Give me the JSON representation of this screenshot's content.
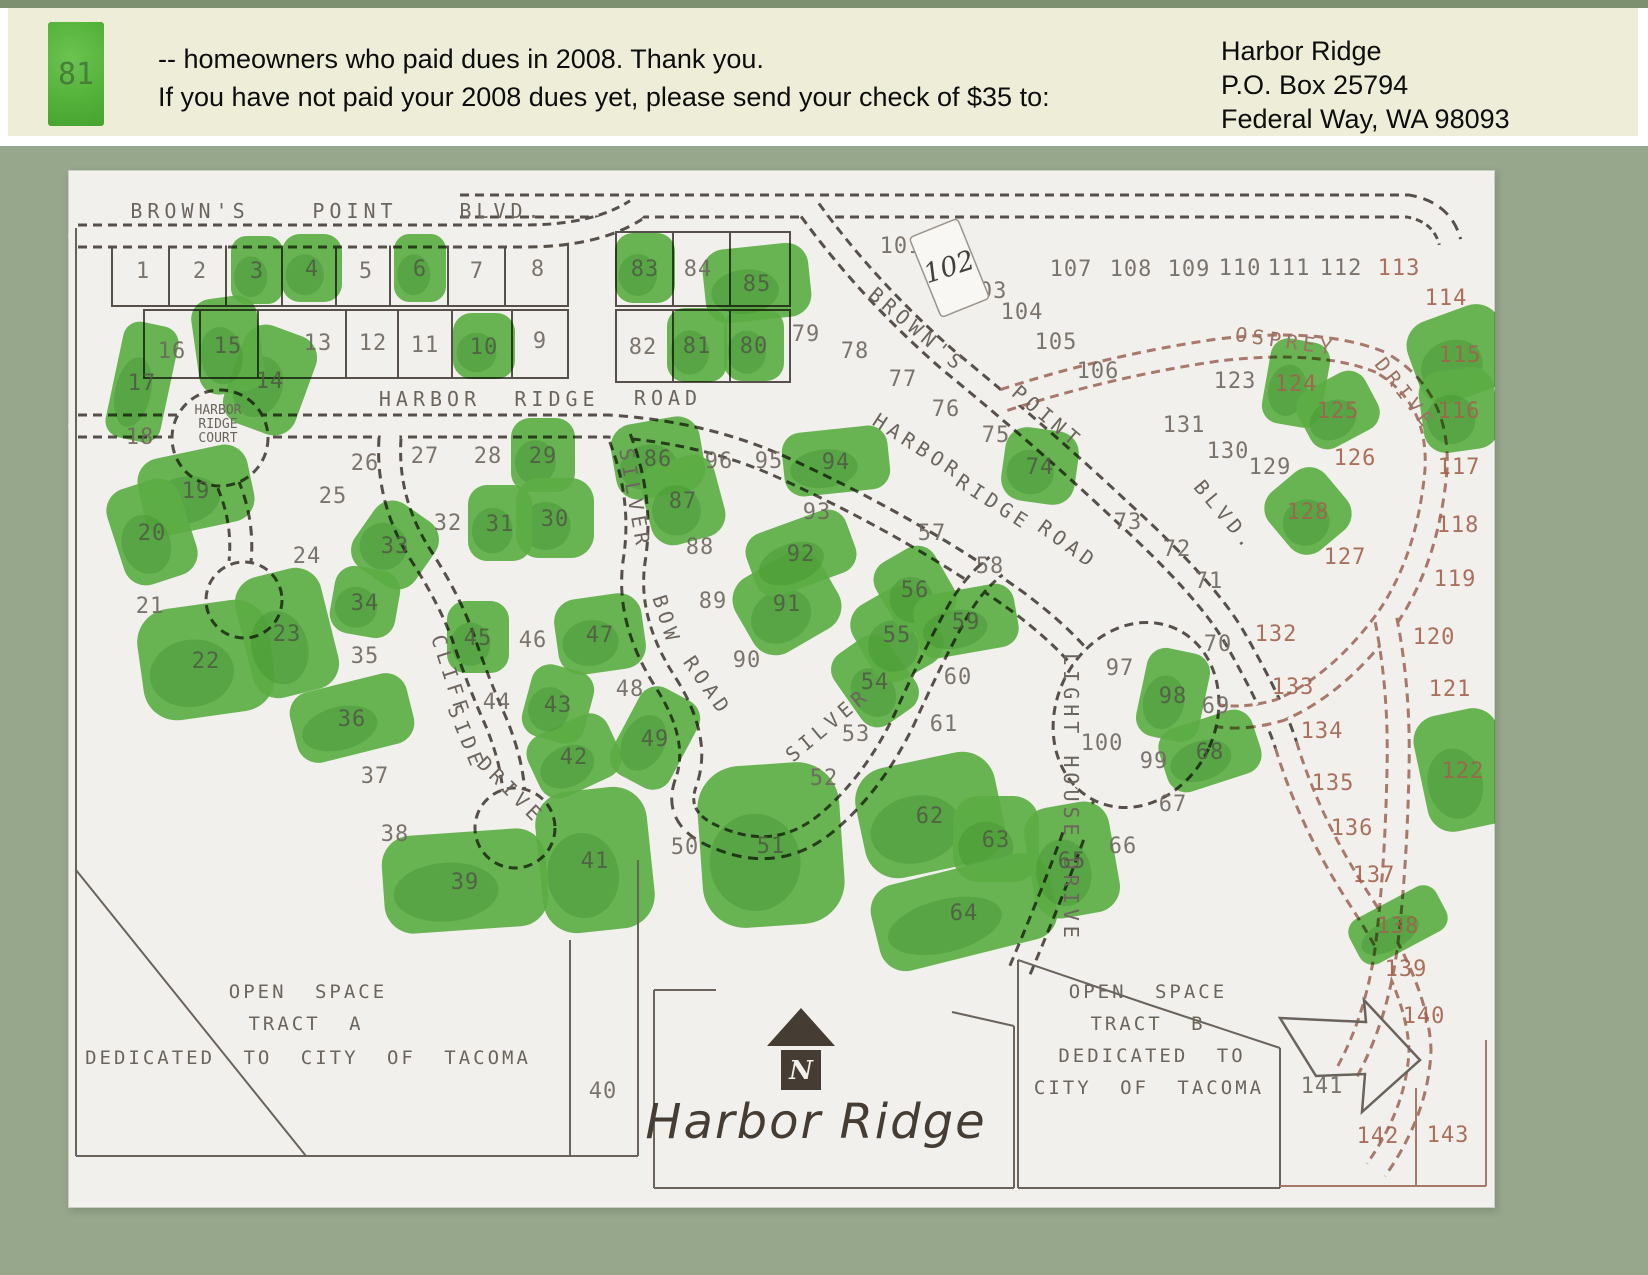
{
  "header": {
    "legend_number": "81",
    "line1": "-- homeowners who paid dues in 2008. Thank you.",
    "line2": "If you have not paid your 2008 dues yet, please send your check of $35 to:",
    "address_lines": [
      "Harbor Ridge",
      "P.O. Box 25794",
      "Federal Way, WA 98093"
    ]
  },
  "colors": {
    "page_bg": "#96a78c",
    "top_strip": "#7d9171",
    "header_bg": "#eeeed8",
    "paper": "#f2f0ec",
    "paid_green": "#62b94a",
    "paid_green_dark": "#3f9630",
    "line_dark": "#57504a",
    "line_red": "#a8796a",
    "number_black": "#6e6760",
    "number_on_green": "#505c44",
    "number_red": "#a2624d",
    "street_text": "#6b655e",
    "street_text_red": "#9b7365",
    "ink": "#453d33"
  },
  "map": {
    "script_title": "Harbor Ridge",
    "north_letter": "N",
    "court_label": [
      "HARBOR",
      "RIDGE",
      "COURT"
    ],
    "handwritten_lot": {
      "n": "102",
      "x": 881,
      "y": 97
    },
    "open_space_labels": [
      {
        "text": "OPEN SPACE",
        "x": 240,
        "y": 828
      },
      {
        "text": "TRACT A",
        "x": 238,
        "y": 860
      },
      {
        "text": "DEDICATED TO CITY OF TACOMA",
        "x": 240,
        "y": 894
      },
      {
        "text": "OPEN SPACE",
        "x": 1080,
        "y": 828
      },
      {
        "text": "TRACT B",
        "x": 1080,
        "y": 860
      },
      {
        "text": "DEDICATED TO",
        "x": 1084,
        "y": 892
      },
      {
        "text": "CITY OF TACOMA",
        "x": 1081,
        "y": 924
      }
    ],
    "street_labels": [
      {
        "text": "BROWN'S",
        "x": 122,
        "y": 48,
        "rot": 0,
        "red": false
      },
      {
        "text": "POINT",
        "x": 287,
        "y": 48,
        "rot": 0,
        "red": false
      },
      {
        "text": "BLVD.",
        "x": 434,
        "y": 48,
        "rot": 0,
        "red": false
      },
      {
        "text": "BROWN'S",
        "x": 845,
        "y": 165,
        "rot": 40,
        "red": false
      },
      {
        "text": "POINT",
        "x": 975,
        "y": 252,
        "rot": 40,
        "red": false
      },
      {
        "text": "BLVD.",
        "x": 1152,
        "y": 350,
        "rot": 50,
        "red": false
      },
      {
        "text": "HARBOR",
        "x": 362,
        "y": 236,
        "rot": 0,
        "red": false
      },
      {
        "text": "RIDGE",
        "x": 489,
        "y": 236,
        "rot": 0,
        "red": false
      },
      {
        "text": "ROAD",
        "x": 600,
        "y": 235,
        "rot": 0,
        "red": false
      },
      {
        "text": "HARBOR",
        "x": 846,
        "y": 282,
        "rot": 33,
        "red": false
      },
      {
        "text": "RIDGE",
        "x": 922,
        "y": 338,
        "rot": 33,
        "red": false
      },
      {
        "text": "ROAD",
        "x": 996,
        "y": 380,
        "rot": 36,
        "red": false
      },
      {
        "text": "SILVER",
        "x": 560,
        "y": 330,
        "rot": 80,
        "red": false
      },
      {
        "text": "BOW",
        "x": 592,
        "y": 452,
        "rot": 72,
        "red": false
      },
      {
        "text": "ROAD",
        "x": 634,
        "y": 520,
        "rot": 55,
        "red": false
      },
      {
        "text": "SILVER",
        "x": 764,
        "y": 560,
        "rot": -40,
        "red": false
      },
      {
        "text": "CLIFF",
        "x": 376,
        "y": 508,
        "rot": 72,
        "red": false
      },
      {
        "text": "SIDE",
        "x": 392,
        "y": 570,
        "rot": 68,
        "red": false
      },
      {
        "text": "DRIVE",
        "x": 438,
        "y": 625,
        "rot": 45,
        "red": false
      },
      {
        "text": "LIGHT HOUSE DRIVE",
        "x": 996,
        "y": 628,
        "rot": 90,
        "red": false
      },
      {
        "text": "OSPREY",
        "x": 1217,
        "y": 178,
        "rot": 8,
        "red": true
      },
      {
        "text": "DRIVE",
        "x": 1332,
        "y": 228,
        "rot": 52,
        "red": true
      }
    ],
    "lots": [
      [
        1,
        75,
        100,
        0,
        0
      ],
      [
        2,
        132,
        100,
        0,
        0
      ],
      [
        3,
        189,
        100,
        1,
        0,
        52,
        68,
        0
      ],
      [
        4,
        244,
        98,
        1,
        0,
        60,
        68,
        0
      ],
      [
        5,
        298,
        100,
        0,
        0
      ],
      [
        6,
        352,
        98,
        1,
        0,
        52,
        68,
        0
      ],
      [
        7,
        409,
        100,
        0,
        0
      ],
      [
        8,
        470,
        98,
        0,
        0
      ],
      [
        9,
        472,
        170,
        0,
        0
      ],
      [
        10,
        416,
        176,
        1,
        0,
        62,
        66,
        0
      ],
      [
        11,
        357,
        174,
        0,
        0
      ],
      [
        12,
        305,
        172,
        0,
        0
      ],
      [
        13,
        250,
        172,
        0,
        0
      ],
      [
        14,
        202,
        210,
        1,
        0,
        76,
        104,
        20
      ],
      [
        15,
        160,
        175,
        1,
        0,
        66,
        96,
        -8
      ],
      [
        16,
        104,
        180,
        0,
        0
      ],
      [
        17,
        74,
        212,
        1,
        0,
        56,
        118,
        12
      ],
      [
        18,
        72,
        266,
        0,
        0
      ],
      [
        19,
        128,
        320,
        1,
        0,
        112,
        78,
        -12
      ],
      [
        20,
        84,
        362,
        1,
        0,
        76,
        100,
        -18
      ],
      [
        21,
        82,
        435,
        0,
        0
      ],
      [
        22,
        138,
        490,
        1,
        0,
        132,
        112,
        -8
      ],
      [
        23,
        219,
        463,
        1,
        0,
        88,
        124,
        -14
      ],
      [
        24,
        239,
        385,
        0,
        0
      ],
      [
        25,
        265,
        325,
        0,
        0
      ],
      [
        26,
        297,
        292,
        0,
        0
      ],
      [
        27,
        357,
        285,
        0,
        0
      ],
      [
        28,
        420,
        285,
        0,
        0
      ],
      [
        29,
        475,
        285,
        1,
        0,
        64,
        74,
        0
      ],
      [
        30,
        487,
        348,
        1,
        0,
        78,
        80,
        0
      ],
      [
        31,
        432,
        353,
        1,
        0,
        64,
        76,
        0
      ],
      [
        32,
        380,
        352,
        0,
        0
      ],
      [
        33,
        327,
        375,
        1,
        0,
        74,
        78,
        35
      ],
      [
        34,
        297,
        432,
        1,
        0,
        66,
        68,
        10
      ],
      [
        35,
        297,
        485,
        0,
        0
      ],
      [
        36,
        284,
        548,
        1,
        0,
        120,
        72,
        -14
      ],
      [
        37,
        307,
        605,
        0,
        0
      ],
      [
        38,
        327,
        663,
        0,
        0
      ],
      [
        39,
        397,
        711,
        1,
        0,
        164,
        98,
        -4
      ],
      [
        40,
        535,
        920,
        0,
        0
      ],
      [
        41,
        527,
        690,
        1,
        0,
        112,
        142,
        -6
      ],
      [
        42,
        506,
        586,
        1,
        0,
        88,
        68,
        -25
      ],
      [
        43,
        490,
        534,
        1,
        0,
        64,
        74,
        15
      ],
      [
        44,
        429,
        531,
        0,
        0
      ],
      [
        45,
        410,
        467,
        1,
        0,
        62,
        72,
        0
      ],
      [
        46,
        465,
        469,
        0,
        0
      ],
      [
        47,
        532,
        464,
        1,
        0,
        88,
        76,
        -8
      ],
      [
        48,
        562,
        518,
        0,
        0
      ],
      [
        49,
        587,
        568,
        1,
        0,
        66,
        98,
        28
      ],
      [
        50,
        617,
        676,
        0,
        0
      ],
      [
        51,
        703,
        675,
        1,
        0,
        142,
        162,
        -4
      ],
      [
        52,
        756,
        607,
        0,
        0
      ],
      [
        53,
        788,
        563,
        0,
        0
      ],
      [
        54,
        807,
        511,
        1,
        0,
        66,
        86,
        -35
      ],
      [
        55,
        829,
        464,
        1,
        0,
        78,
        86,
        -30
      ],
      [
        56,
        847,
        419,
        1,
        0,
        68,
        78,
        -30
      ],
      [
        57,
        864,
        362,
        0,
        0
      ],
      [
        58,
        922,
        395,
        0,
        0
      ],
      [
        59,
        898,
        451,
        1,
        0,
        102,
        64,
        -10
      ],
      [
        60,
        890,
        506,
        0,
        0
      ],
      [
        61,
        876,
        553,
        0,
        0
      ],
      [
        62,
        862,
        645,
        1,
        0,
        142,
        112,
        -12
      ],
      [
        63,
        928,
        669,
        1,
        0,
        86,
        86,
        0
      ],
      [
        64,
        896,
        742,
        1,
        0,
        182,
        88,
        -14
      ],
      [
        65,
        1004,
        690,
        1,
        0,
        86,
        112,
        -10
      ],
      [
        66,
        1055,
        675,
        0,
        0
      ],
      [
        67,
        1105,
        633,
        0,
        0
      ],
      [
        68,
        1142,
        581,
        1,
        0,
        98,
        66,
        -18
      ],
      [
        69,
        1148,
        535,
        0,
        0
      ],
      [
        70,
        1150,
        473,
        0,
        0
      ],
      [
        71,
        1141,
        410,
        0,
        0
      ],
      [
        72,
        1109,
        378,
        0,
        0
      ],
      [
        73,
        1060,
        351,
        0,
        0
      ],
      [
        74,
        972,
        296,
        1,
        0,
        74,
        74,
        8
      ],
      [
        75,
        928,
        264,
        0,
        0
      ],
      [
        76,
        878,
        238,
        0,
        0
      ],
      [
        77,
        835,
        208,
        0,
        0
      ],
      [
        78,
        787,
        180,
        0,
        0
      ],
      [
        79,
        738,
        163,
        0,
        0
      ],
      [
        80,
        686,
        175,
        1,
        0,
        60,
        72,
        0
      ],
      [
        81,
        629,
        175,
        1,
        0,
        60,
        74,
        0
      ],
      [
        82,
        575,
        176,
        0,
        0
      ],
      [
        83,
        577,
        98,
        1,
        0,
        60,
        70,
        0
      ],
      [
        84,
        630,
        98,
        0,
        0
      ],
      [
        85,
        689,
        113,
        1,
        0,
        106,
        74,
        -6
      ],
      [
        86,
        590,
        288,
        1,
        0,
        90,
        76,
        -10
      ],
      [
        87,
        615,
        330,
        1,
        0,
        76,
        84,
        -15
      ],
      [
        88,
        632,
        376,
        0,
        0
      ],
      [
        89,
        645,
        430,
        0,
        0
      ],
      [
        90,
        679,
        489,
        0,
        0
      ],
      [
        91,
        719,
        433,
        1,
        0,
        98,
        86,
        -30
      ],
      [
        92,
        733,
        383,
        1,
        0,
        106,
        66,
        -20
      ],
      [
        93,
        749,
        341,
        0,
        0
      ],
      [
        94,
        768,
        291,
        1,
        0,
        106,
        64,
        -6
      ],
      [
        95,
        701,
        290,
        0,
        0
      ],
      [
        96,
        651,
        290,
        0,
        0
      ],
      [
        97,
        1052,
        497,
        0,
        0
      ],
      [
        98,
        1105,
        525,
        1,
        0,
        64,
        90,
        12
      ],
      [
        99,
        1086,
        590,
        0,
        0
      ],
      [
        100,
        1034,
        572,
        0,
        0
      ],
      [
        101,
        833,
        75,
        0,
        0
      ],
      [
        103,
        918,
        120,
        0,
        0
      ],
      [
        104,
        954,
        141,
        0,
        0
      ],
      [
        105,
        988,
        171,
        0,
        0
      ],
      [
        106,
        1030,
        200,
        0,
        0
      ],
      [
        107,
        1003,
        98,
        0,
        0
      ],
      [
        108,
        1063,
        98,
        0,
        0
      ],
      [
        109,
        1121,
        98,
        0,
        0
      ],
      [
        110,
        1172,
        97,
        0,
        0
      ],
      [
        111,
        1221,
        97,
        0,
        0
      ],
      [
        112,
        1273,
        97,
        0,
        0
      ],
      [
        113,
        1331,
        97,
        0,
        1
      ],
      [
        114,
        1378,
        127,
        0,
        1
      ],
      [
        115,
        1392,
        184,
        1,
        1,
        98,
        86,
        -20
      ],
      [
        116,
        1391,
        240,
        1,
        1,
        76,
        82,
        -8
      ],
      [
        117,
        1391,
        296,
        0,
        1
      ],
      [
        118,
        1390,
        354,
        0,
        1
      ],
      [
        119,
        1387,
        408,
        0,
        1
      ],
      [
        120,
        1366,
        466,
        0,
        1
      ],
      [
        121,
        1382,
        518,
        0,
        1
      ],
      [
        122,
        1395,
        600,
        1,
        1,
        86,
        118,
        -12
      ],
      [
        123,
        1167,
        210,
        0,
        0
      ],
      [
        124,
        1228,
        213,
        1,
        1,
        60,
        86,
        10
      ],
      [
        125,
        1270,
        240,
        1,
        1,
        76,
        64,
        -28
      ],
      [
        126,
        1287,
        287,
        0,
        1
      ],
      [
        127,
        1277,
        386,
        0,
        1
      ],
      [
        128,
        1240,
        341,
        1,
        1,
        74,
        76,
        -40
      ],
      [
        129,
        1202,
        296,
        0,
        0
      ],
      [
        130,
        1160,
        280,
        0,
        0
      ],
      [
        131,
        1116,
        254,
        0,
        0
      ],
      [
        132,
        1208,
        463,
        0,
        1
      ],
      [
        133,
        1225,
        516,
        0,
        1
      ],
      [
        134,
        1254,
        560,
        0,
        1
      ],
      [
        135,
        1265,
        612,
        0,
        1
      ],
      [
        136,
        1284,
        657,
        0,
        1
      ],
      [
        137,
        1306,
        704,
        0,
        1
      ],
      [
        138,
        1330,
        755,
        1,
        1,
        98,
        50,
        -28
      ],
      [
        139,
        1338,
        798,
        0,
        1
      ],
      [
        140,
        1356,
        845,
        0,
        1
      ],
      [
        141,
        1254,
        915,
        0,
        0
      ],
      [
        142,
        1310,
        965,
        0,
        1
      ],
      [
        143,
        1380,
        964,
        0,
        1
      ]
    ]
  }
}
